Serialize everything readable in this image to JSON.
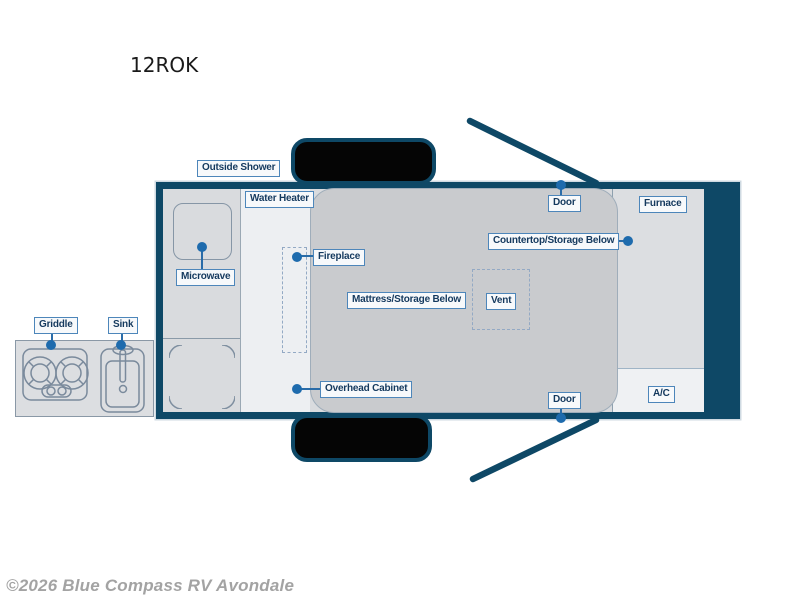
{
  "title": "12ROK",
  "watermark": "©2026 Blue Compass RV Avondale",
  "colors": {
    "wall": "#0e4866",
    "label_border": "#4d86ba",
    "label_text": "#14395e",
    "leader_dot": "#1e6bad",
    "interior_gray": "#c9cbce",
    "cabinet_gray": "#d9dbde",
    "hallway_light": "#edeff2",
    "watermark_gray": "#a3a3a3"
  },
  "labels": {
    "outside_shower": "Outside Shower",
    "water_heater": "Water Heater",
    "microwave": "Microwave",
    "fireplace": "Fireplace",
    "mattress": "Mattress/Storage Below",
    "vent": "Vent",
    "door_top": "Door",
    "countertop": "Countertop/Storage Below",
    "furnace": "Furnace",
    "overhead_cabinet": "Overhead Cabinet",
    "door_bottom": "Door",
    "ac": "A/C",
    "griddle": "Griddle",
    "sink": "Sink"
  }
}
